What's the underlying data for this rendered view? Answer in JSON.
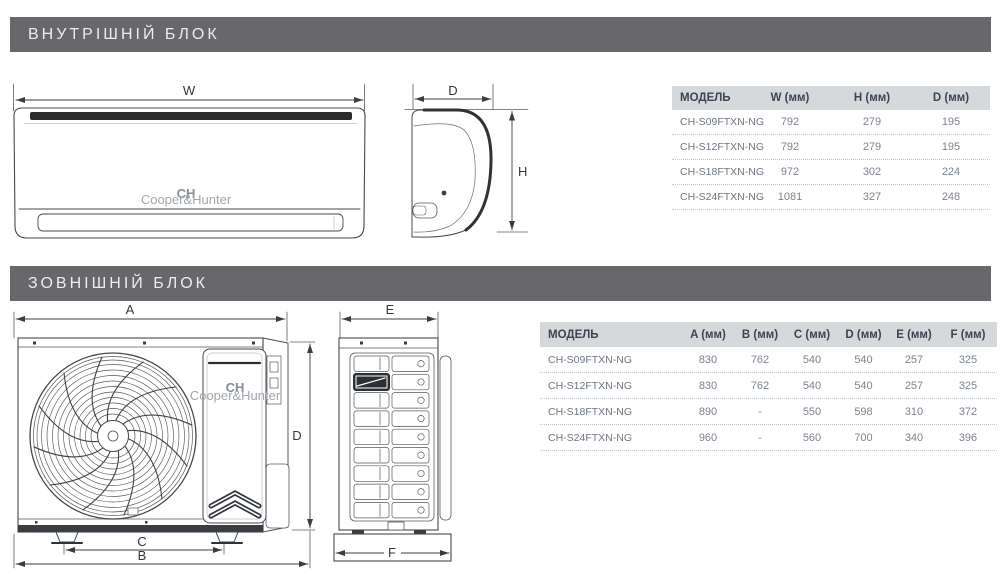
{
  "sections": {
    "indoor_title": "ВНУТРІШНІЙ БЛОК",
    "outdoor_title": "ЗОВНІШНІЙ БЛОК"
  },
  "colors": {
    "banner_bg": "#67676c",
    "banner_text": "#ededef",
    "table_header_bg": "#d6d9dc",
    "table_header_text": "#3d4450",
    "table_value_text": "#7c838d",
    "diagram_line": "#44474c"
  },
  "indoor_table": {
    "headers": {
      "model": "МОДЕЛЬ",
      "w": "W (мм)",
      "h": "H (мм)",
      "d": "D (мм)"
    },
    "rows": [
      {
        "model": "CH-S09FTXN-NG",
        "w": "792",
        "h": "279",
        "d": "195"
      },
      {
        "model": "CH-S12FTXN-NG",
        "w": "792",
        "h": "279",
        "d": "195"
      },
      {
        "model": "CH-S18FTXN-NG",
        "w": "972",
        "h": "302",
        "d": "224"
      },
      {
        "model": "CH-S24FTXN-NG",
        "w": "1081",
        "h": "327",
        "d": "248"
      }
    ]
  },
  "outdoor_table": {
    "headers": {
      "model": "МОДЕЛЬ",
      "a": "A (мм)",
      "b": "B (мм)",
      "c": "C (мм)",
      "d": "D (мм)",
      "e": "E (мм)",
      "f": "F (мм)"
    },
    "rows": [
      {
        "model": "CH-S09FTXN-NG",
        "a": "830",
        "b": "762",
        "c": "540",
        "d": "540",
        "e": "257",
        "f": "325"
      },
      {
        "model": "CH-S12FTXN-NG",
        "a": "830",
        "b": "762",
        "c": "540",
        "d": "540",
        "e": "257",
        "f": "325"
      },
      {
        "model": "CH-S18FTXN-NG",
        "a": "890",
        "b": "-",
        "c": "550",
        "d": "598",
        "e": "310",
        "f": "372"
      },
      {
        "model": "CH-S24FTXN-NG",
        "a": "960",
        "b": "-",
        "c": "560",
        "d": "700",
        "e": "340",
        "f": "396"
      }
    ]
  },
  "diagrams": {
    "indoor_front": {
      "dim_w": "W",
      "logo": "CH",
      "logo_sub": "Cooper&Hunter"
    },
    "indoor_side": {
      "dim_d": "D",
      "dim_h": "H"
    },
    "outdoor_front": {
      "dim_a": "A",
      "dim_b": "B",
      "dim_c": "C",
      "dim_d": "D",
      "logo": "CH",
      "logo_sub": "Cooper&Hunter"
    },
    "outdoor_side": {
      "dim_e": "E",
      "dim_f": "F"
    }
  }
}
